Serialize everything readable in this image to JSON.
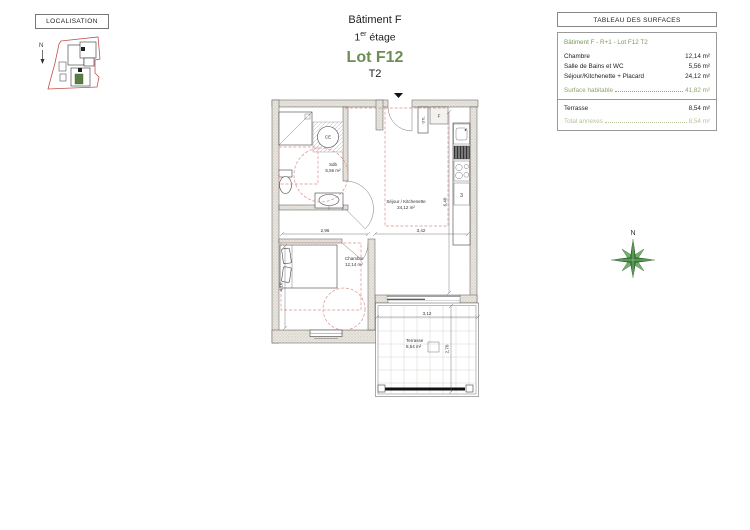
{
  "localisation": {
    "title": "LOCALISATION",
    "north": "N"
  },
  "title_block": {
    "building": "Bâtiment F",
    "floor_num": "1",
    "floor_sup": "er",
    "floor_word": " étage",
    "lot": "Lot F12",
    "type": "T2"
  },
  "surface_table": {
    "title": "TABLEAU DES SURFACES",
    "header": "Bâtiment F - R+1 - Lot F12 T2",
    "rows": [
      {
        "label": "Chambre",
        "value": "12,14 m²"
      },
      {
        "label": "Salle de Bains et WC",
        "value": "5,56 m²"
      },
      {
        "label": "Séjour/Kitchenette + Placard",
        "value": "24,12 m²"
      }
    ],
    "habitable": {
      "label": "Surface habitable",
      "value": "41,82 m²"
    },
    "terrasse": {
      "label": "Terrasse",
      "value": "8,54 m²"
    },
    "total": {
      "label": "Total annexes",
      "value": "8,54 m²"
    }
  },
  "plan": {
    "rooms": {
      "sdb": {
        "name": "Sdb",
        "area": "5,56 m²"
      },
      "sejour": {
        "name": "Séjour / Kitchenette",
        "area": "24,12 m²"
      },
      "chambre": {
        "name": "Chambre",
        "area": "12,14 m²"
      },
      "terrasse": {
        "name": "Terrasse",
        "area": "8,54 m²"
      }
    },
    "fixtures": {
      "water_heater": "CE",
      "gtl": "GTL",
      "f": "F",
      "fridge_mark": "3"
    },
    "dims": {
      "chambre_w": "2,96",
      "sejour_w": "3,42",
      "sejour_h": "6,40",
      "chambre_h": "4,10",
      "terrasse_w": "3,12",
      "terrasse_h": "2,70"
    }
  },
  "compass": {
    "north": "N"
  },
  "colors": {
    "green": "#6c8d54",
    "light_green": "#8aa56c",
    "pale_green": "#b3c49b",
    "red_dash": "#dd8f8f"
  }
}
